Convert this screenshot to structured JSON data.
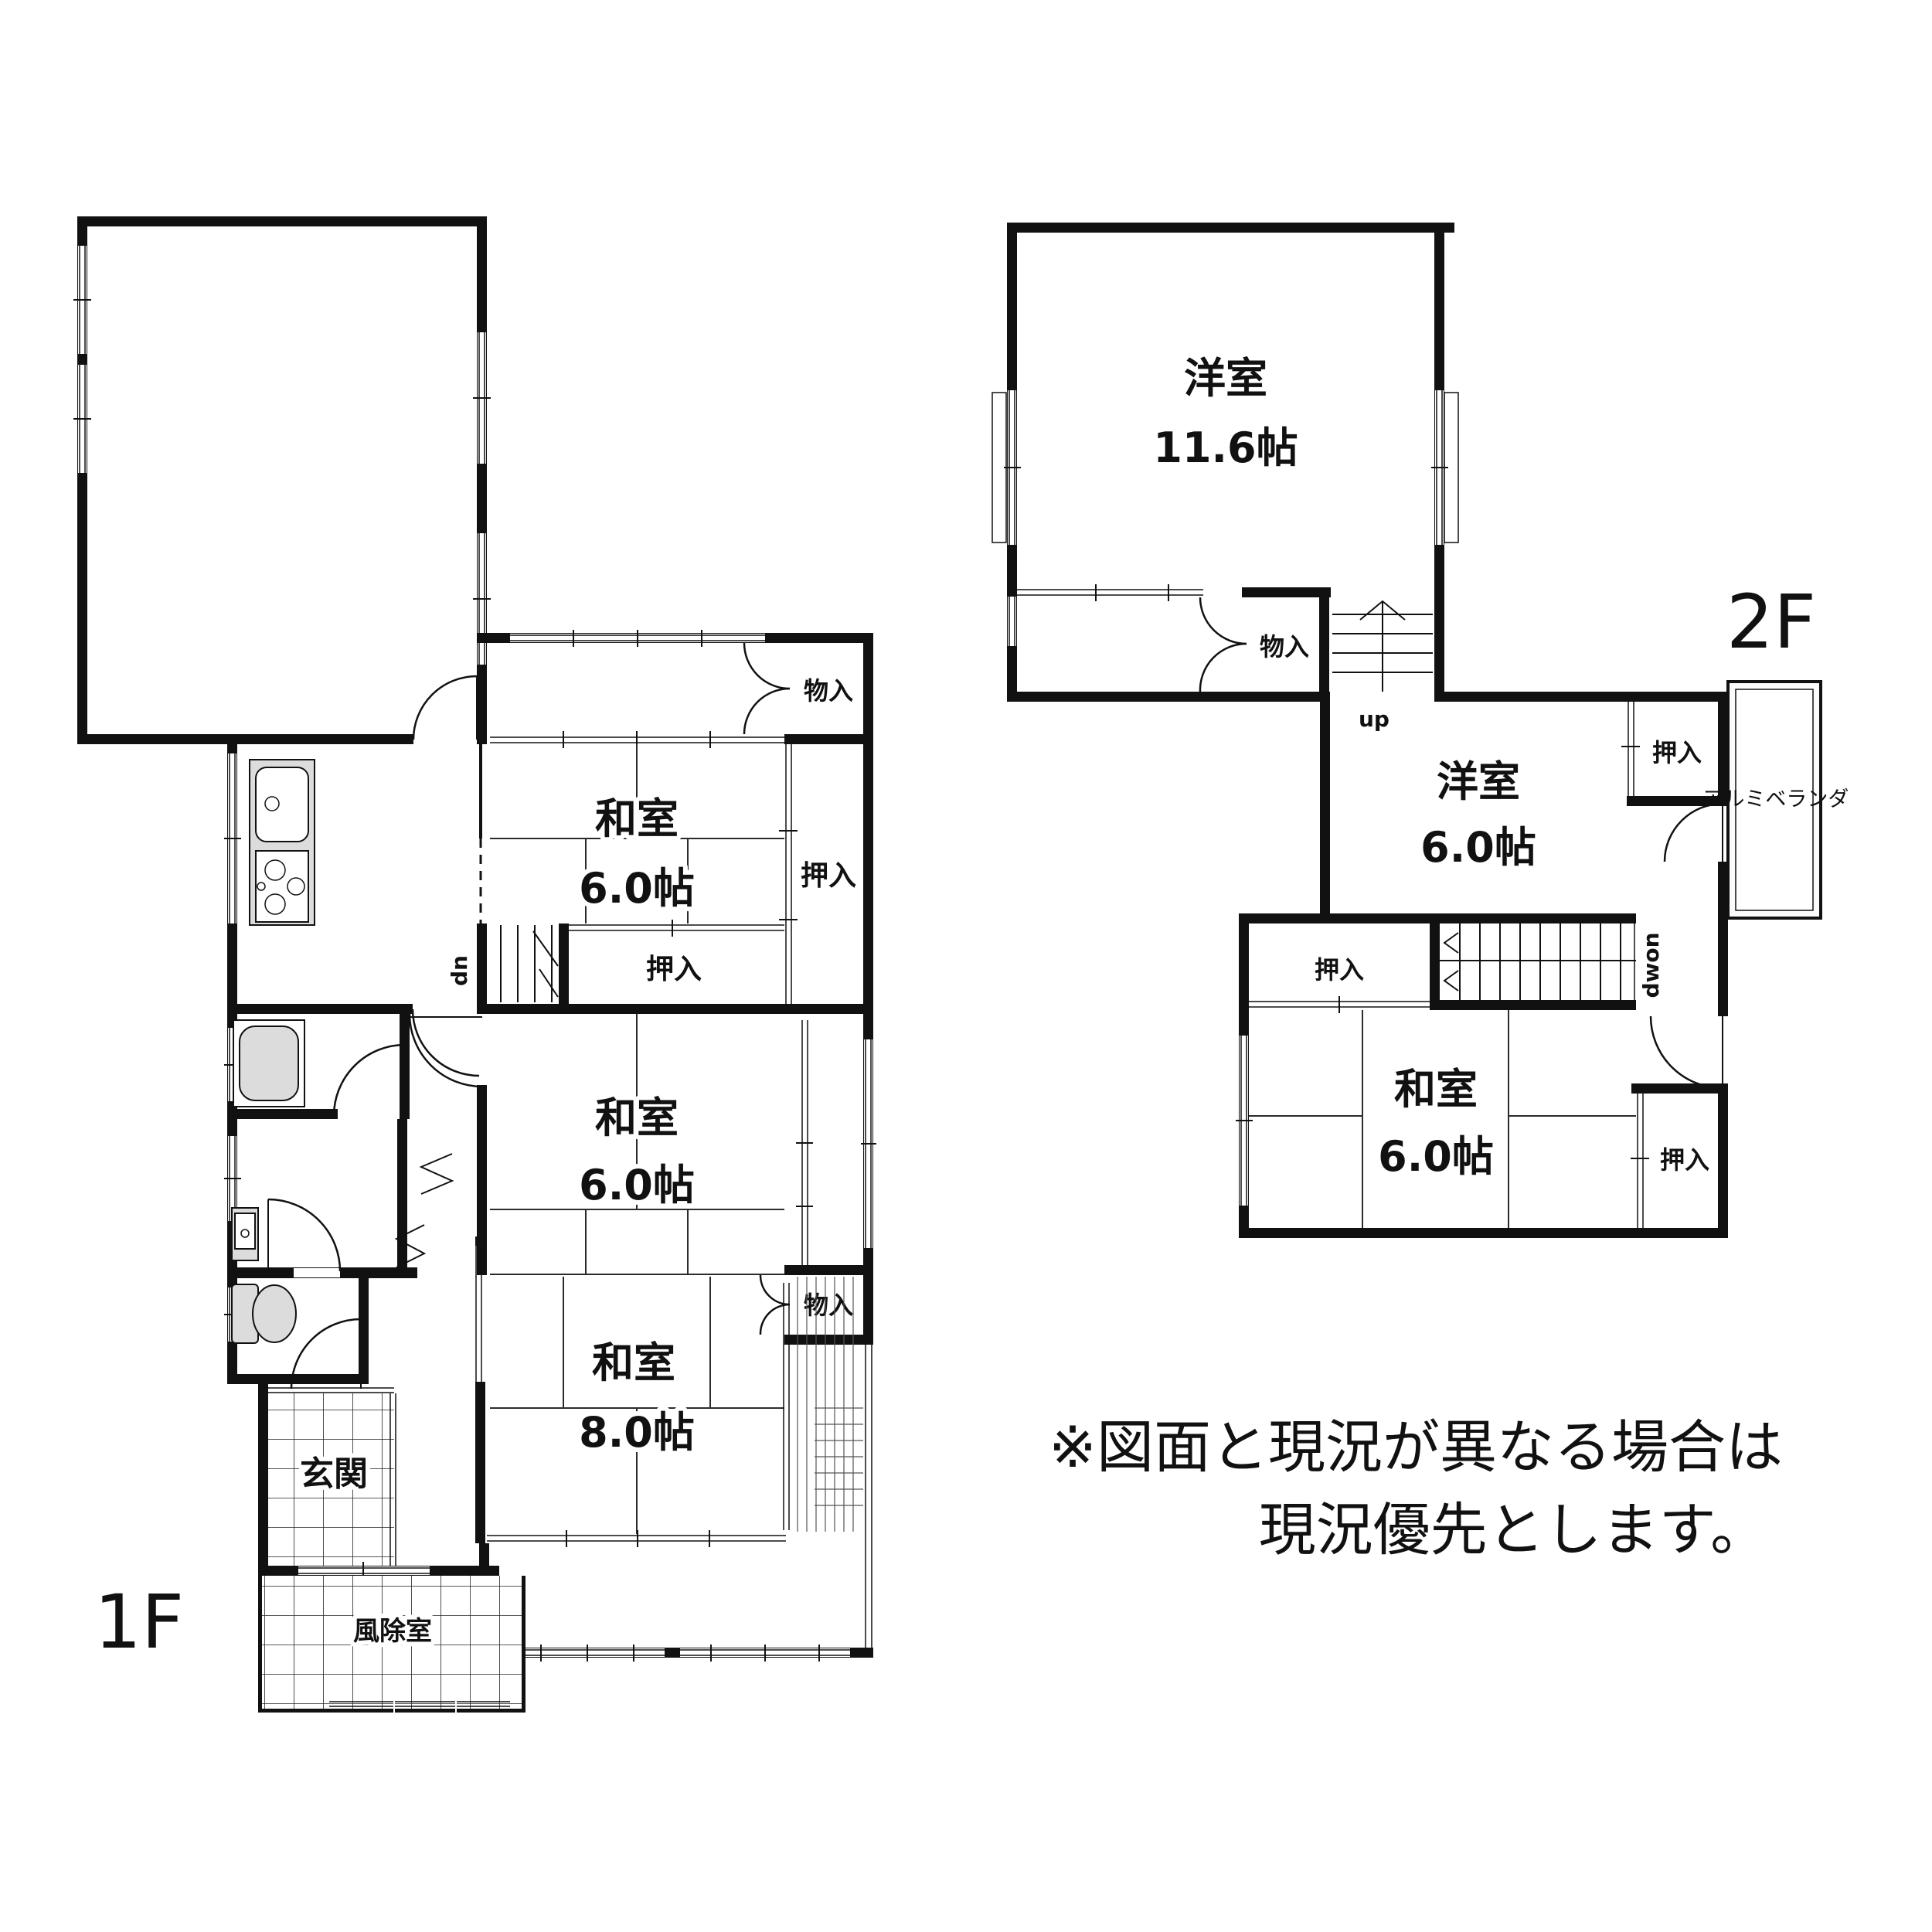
{
  "note": {
    "line1": "※図面と現況が異なる場合は",
    "line2": "現況優先とします。"
  },
  "floor1": {
    "label": "1F",
    "rooms": {
      "storage": "物置",
      "closet_top": "物入",
      "washitsu1_name": "和室",
      "washitsu1_size": "6.0帖",
      "oshiire_side": "押入",
      "oshiire_mid": "押入",
      "washitsu2_name": "和室",
      "washitsu2_size": "6.0帖",
      "closet_low": "物入",
      "washitsu3_name": "和室",
      "washitsu3_size": "8.0帖",
      "genkan": "玄関",
      "windbreak": "風除室",
      "stair_down": "dn"
    }
  },
  "floor2": {
    "label": "2F",
    "rooms": {
      "yoshitsu1_name": "洋室",
      "yoshitsu1_size": "11.6帖",
      "closet": "物入",
      "stair_up": "up",
      "yoshitsu2_name": "洋室",
      "yoshitsu2_size": "6.0帖",
      "oshiire_ne": "押入",
      "veranda": "アルミベランダ",
      "stair_down": "dwon",
      "oshiire_w": "押入",
      "washitsu_name": "和室",
      "washitsu_size": "6.0帖",
      "oshiire_e": "押入"
    }
  },
  "colors": {
    "wall": "#111111",
    "fixture": "#dcdcdc",
    "background": "#ffffff"
  }
}
